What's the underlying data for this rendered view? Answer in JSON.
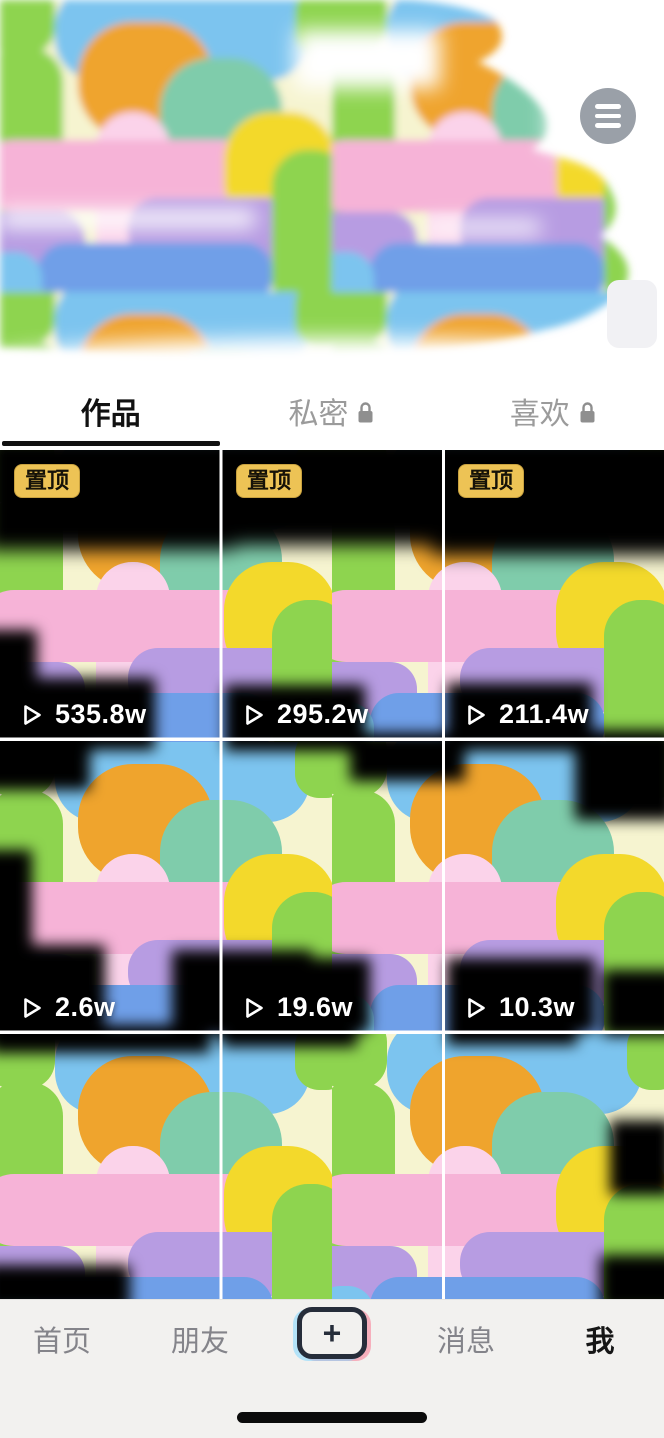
{
  "header": {
    "menu_button": {
      "icon": "hamburger-icon"
    }
  },
  "tabs": {
    "items": [
      {
        "label": "作品",
        "active": true,
        "locked": false
      },
      {
        "label": "私密",
        "active": false,
        "locked": true
      },
      {
        "label": "喜欢",
        "active": false,
        "locked": true
      }
    ]
  },
  "grid": {
    "pinned_label": "置顶",
    "play_icon": "play-outline-icon",
    "videos": [
      {
        "views": "535.8w",
        "pinned": true
      },
      {
        "views": "295.2w",
        "pinned": true
      },
      {
        "views": "211.4w",
        "pinned": true
      },
      {
        "views": "2.6w",
        "pinned": false
      },
      {
        "views": "19.6w",
        "pinned": false
      },
      {
        "views": "10.3w",
        "pinned": false
      }
    ]
  },
  "bottom_nav": {
    "items": [
      {
        "label": "首页",
        "active": false
      },
      {
        "label": "朋友",
        "active": false
      },
      {
        "label": "+",
        "type": "create-button"
      },
      {
        "label": "消息",
        "active": false
      },
      {
        "label": "我",
        "active": true
      }
    ]
  },
  "colors": {
    "badge_gold": "#edc355",
    "nav_bg": "#f2f1ef",
    "accent_dark": "#262d3a",
    "menu_gray": "#9aa0a8",
    "paint_palette": [
      "#8ed44f",
      "#f6b3d7",
      "#fbd3ea",
      "#f3d92b",
      "#7fccab",
      "#b79ce2",
      "#6f9fe8",
      "#7cc4ef",
      "#efa42d",
      "#f6f4d0"
    ]
  }
}
